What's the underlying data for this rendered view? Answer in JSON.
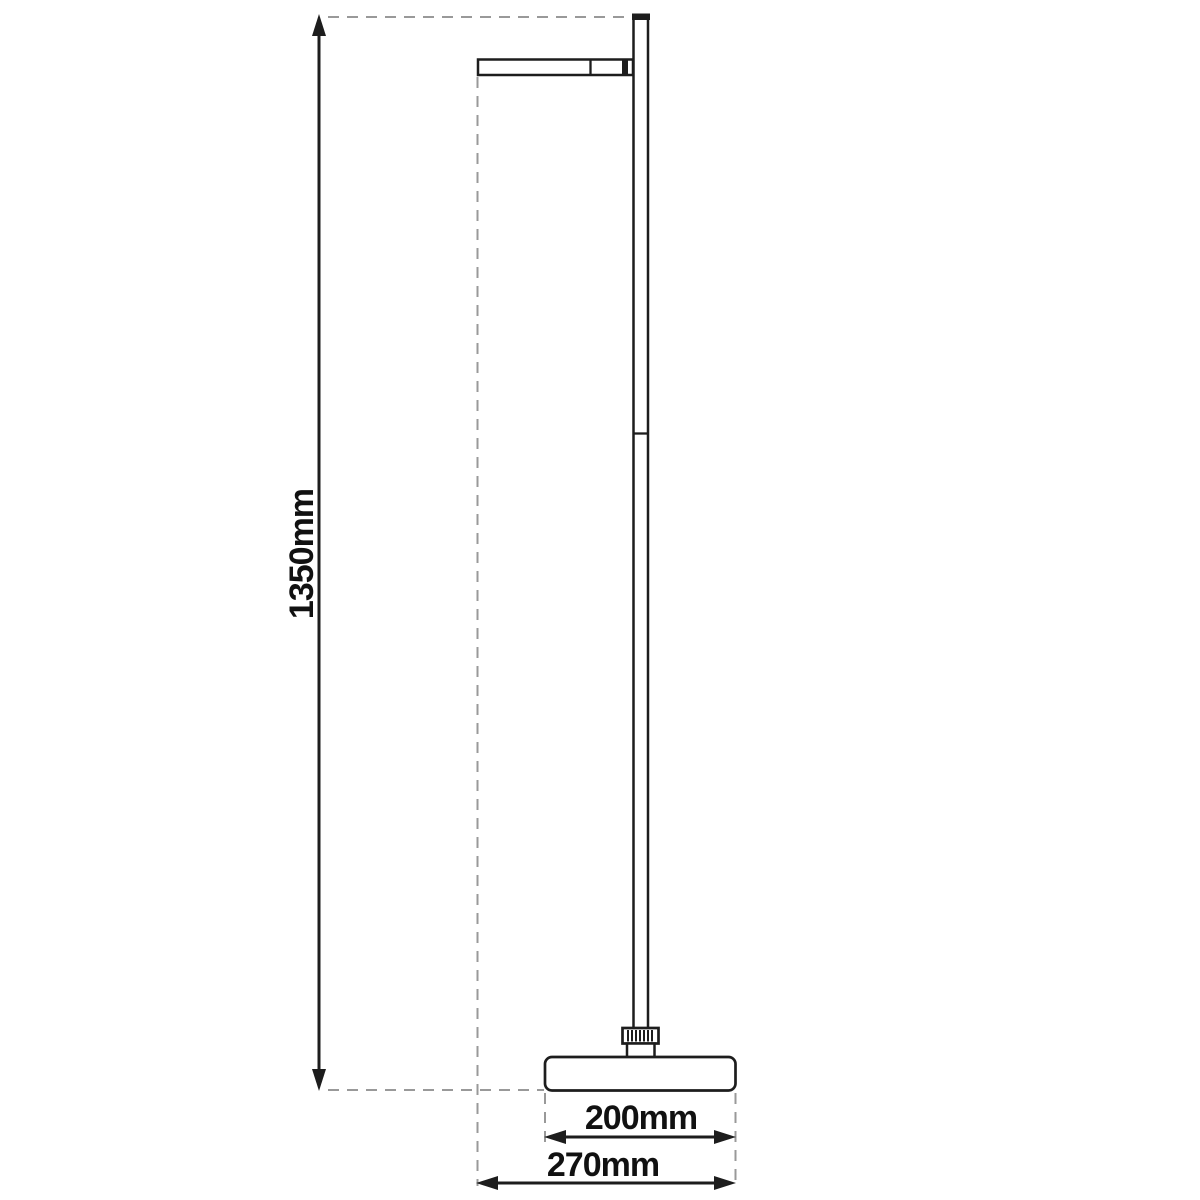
{
  "colors": {
    "line": "#1d1d1d",
    "dashed": "#999999",
    "text": "#111111",
    "background": "#ffffff"
  },
  "dimensions": {
    "height": {
      "label": "1350mm",
      "value_mm": 1350
    },
    "base_width": {
      "label": "200mm",
      "value_mm": 200
    },
    "overall_width": {
      "label": "270mm",
      "value_mm": 270
    }
  }
}
